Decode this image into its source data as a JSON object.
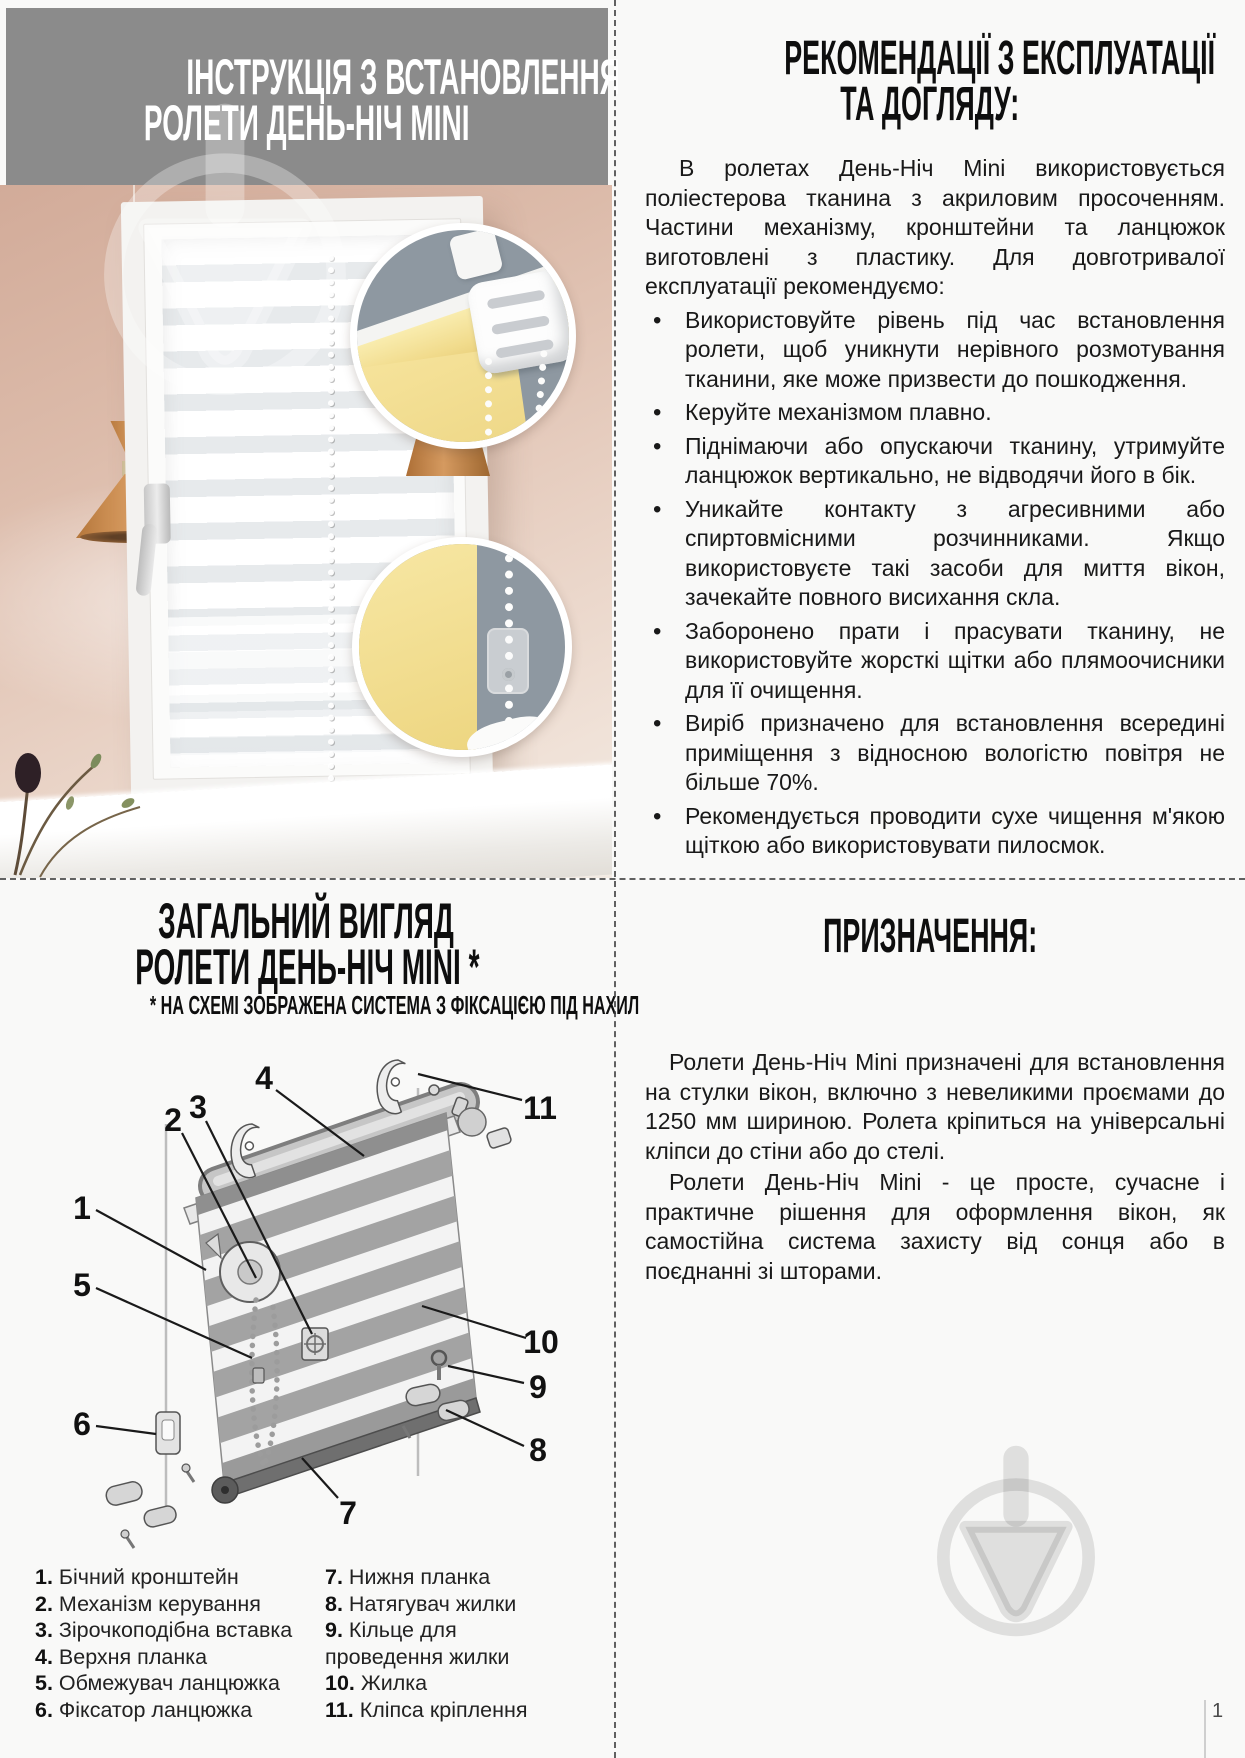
{
  "page": {
    "number": "1"
  },
  "icons": {
    "watermark": "trowel-circle-logo"
  },
  "colors": {
    "header_gray": "#8b8b8b",
    "wall_pink": "#dcbbaa",
    "inset_bg": "#8e98a1",
    "blind_yellow": "#f1db8c",
    "lamp_copper": "#c98f54",
    "text": "#191919"
  },
  "top_left": {
    "title_line1": "ІНСТРУКЦІЯ З ВСТАНОВЛЕННЯ",
    "title_line2": "РОЛЕТИ ДЕНЬ-НІЧ MINI"
  },
  "top_right": {
    "title_line1": "РЕКОМЕНДАЦІЇ З ЕКСПЛУАТАЦІЇ",
    "title_line2": "ТА ДОГЛЯДУ:",
    "intro": "В ролетах День-Ніч Mini використовується поліестерова тканина з акриловим просоченням. Частини механізму, кронштейни та ланцюжок виготовлені з пластику. Для довготривалої експлуатації рекомендуємо:",
    "bullets": [
      "Використовуйте рівень під час встановлення ролети, щоб уникнути нерівного розмотування тканини, яке може призвести до пошкодження.",
      "Керуйте механізмом плавно.",
      "Піднімаючи або опускаючи тканину, утримуйте ланцюжок вертикально, не відводячи його в бік.",
      "Уникайте контакту з агресивними або спиртовмісними розчинниками. Якщо використовуєте такі засоби для миття вікон, зачекайте повного висихання скла.",
      "Заборонено прати і прасувати тканину, не використовуйте жорсткі щітки або плямоочисники для її очищення.",
      "Виріб призначено для встановлення всередині приміщення з відносною вологістю повітря не більше 70%.",
      "Рекомендується проводити сухе чищення м'якою щіткою або використовувати пилосмок."
    ]
  },
  "bottom_left": {
    "title_line1": "ЗАГАЛЬНИЙ ВИГЛЯД",
    "title_line2": "РОЛЕТИ ДЕНЬ-НІЧ MINI *",
    "subtitle": "* НА СХЕМІ ЗОБРАЖЕНА СИСТЕМА З ФІКСАЦІЄЮ ПІД НАХИЛ",
    "callouts": [
      "1",
      "2",
      "3",
      "4",
      "5",
      "6",
      "7",
      "8",
      "9",
      "10",
      "11"
    ],
    "legend_left": [
      {
        "num": "1.",
        "label": "Бічний кронштейн"
      },
      {
        "num": "2.",
        "label": "Механізм керування"
      },
      {
        "num": "3.",
        "label": "Зірочкоподібна вставка"
      },
      {
        "num": "4.",
        "label": "Верхня планка"
      },
      {
        "num": "5.",
        "label": "Обмежувач ланцюжка"
      },
      {
        "num": "6.",
        "label": "Фіксатор ланцюжка"
      }
    ],
    "legend_right": [
      {
        "num": "7.",
        "label": "Нижня планка"
      },
      {
        "num": "8.",
        "label": "Натягувач жилки"
      },
      {
        "num": "9.",
        "label": "Кільце для проведення жилки"
      },
      {
        "num": "10.",
        "label": "Жилка"
      },
      {
        "num": "11.",
        "label": "Кліпса кріплення"
      }
    ]
  },
  "bottom_right": {
    "title": "ПРИЗНАЧЕННЯ:",
    "para1": "Ролети День-Ніч Mini призначені для встановлення на стулки вікон, включно з невеликими проємами до 1250 мм шириною. Ролета кріпиться на універсальні кліпси до стіни або до стелі.",
    "para2": "Ролети День-Ніч Mini - це просте, сучасне і практичне рішення для оформлення вікон, як самостійна система захисту від сонця або в поєднанні зі шторами."
  }
}
